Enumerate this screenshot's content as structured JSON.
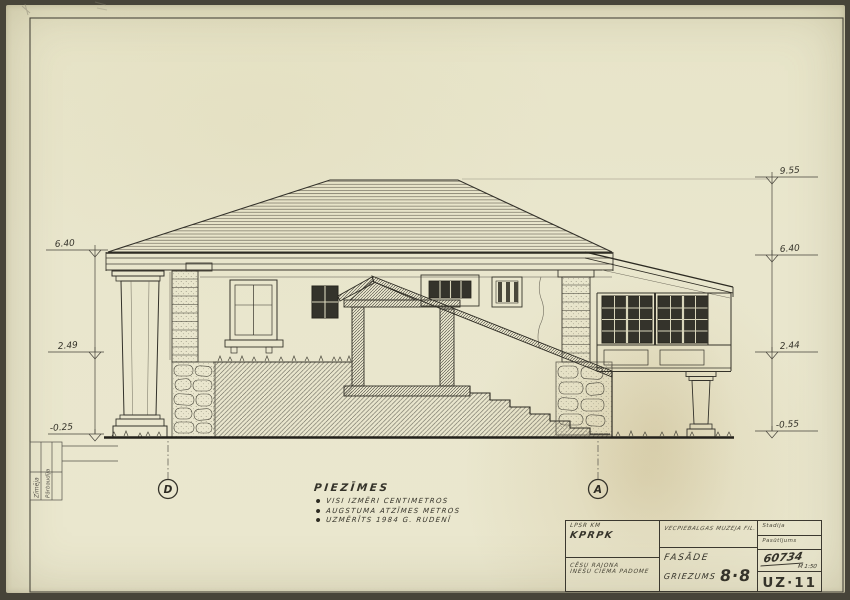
{
  "colors": {
    "paper": "#e9e6cd",
    "ink": "#35332a",
    "ink_light": "#6e6a5c",
    "glass_dark": "#34332b",
    "ground_bold": "#23211b"
  },
  "levels": {
    "left": [
      "6.40",
      "2.49",
      "-0.25"
    ],
    "right": [
      "9.55",
      "6.40",
      "2.44",
      "-0.55"
    ]
  },
  "axes": {
    "left": "D",
    "right": "A"
  },
  "notes": {
    "title": "PIEZĪMES",
    "items": [
      "VISI IZMĒRI CENTIMETROS",
      "AUGSTUMA ATZĪMES METROS",
      "UZMĒRĪTS 1984 G. RUDENĪ"
    ]
  },
  "title_block": {
    "org1": "LPSR KM",
    "org2": "KPRPK",
    "client1": "CĒSU RAJONA",
    "client2": "INEŠU CIEMA PADOME",
    "project": "VECPIEBALGAS MUZEJA FIL.",
    "name1": "FASĀDE",
    "name2": "GRIEZUMS",
    "section": "8·8",
    "stage_label": "Stadija",
    "order_label": "Pasūtījums",
    "number": "60734",
    "scale": "M 1:50",
    "code": "UZ·11"
  },
  "side_stamp": {
    "row1": "Zīmēja",
    "row2": "Pārbaudīja"
  }
}
